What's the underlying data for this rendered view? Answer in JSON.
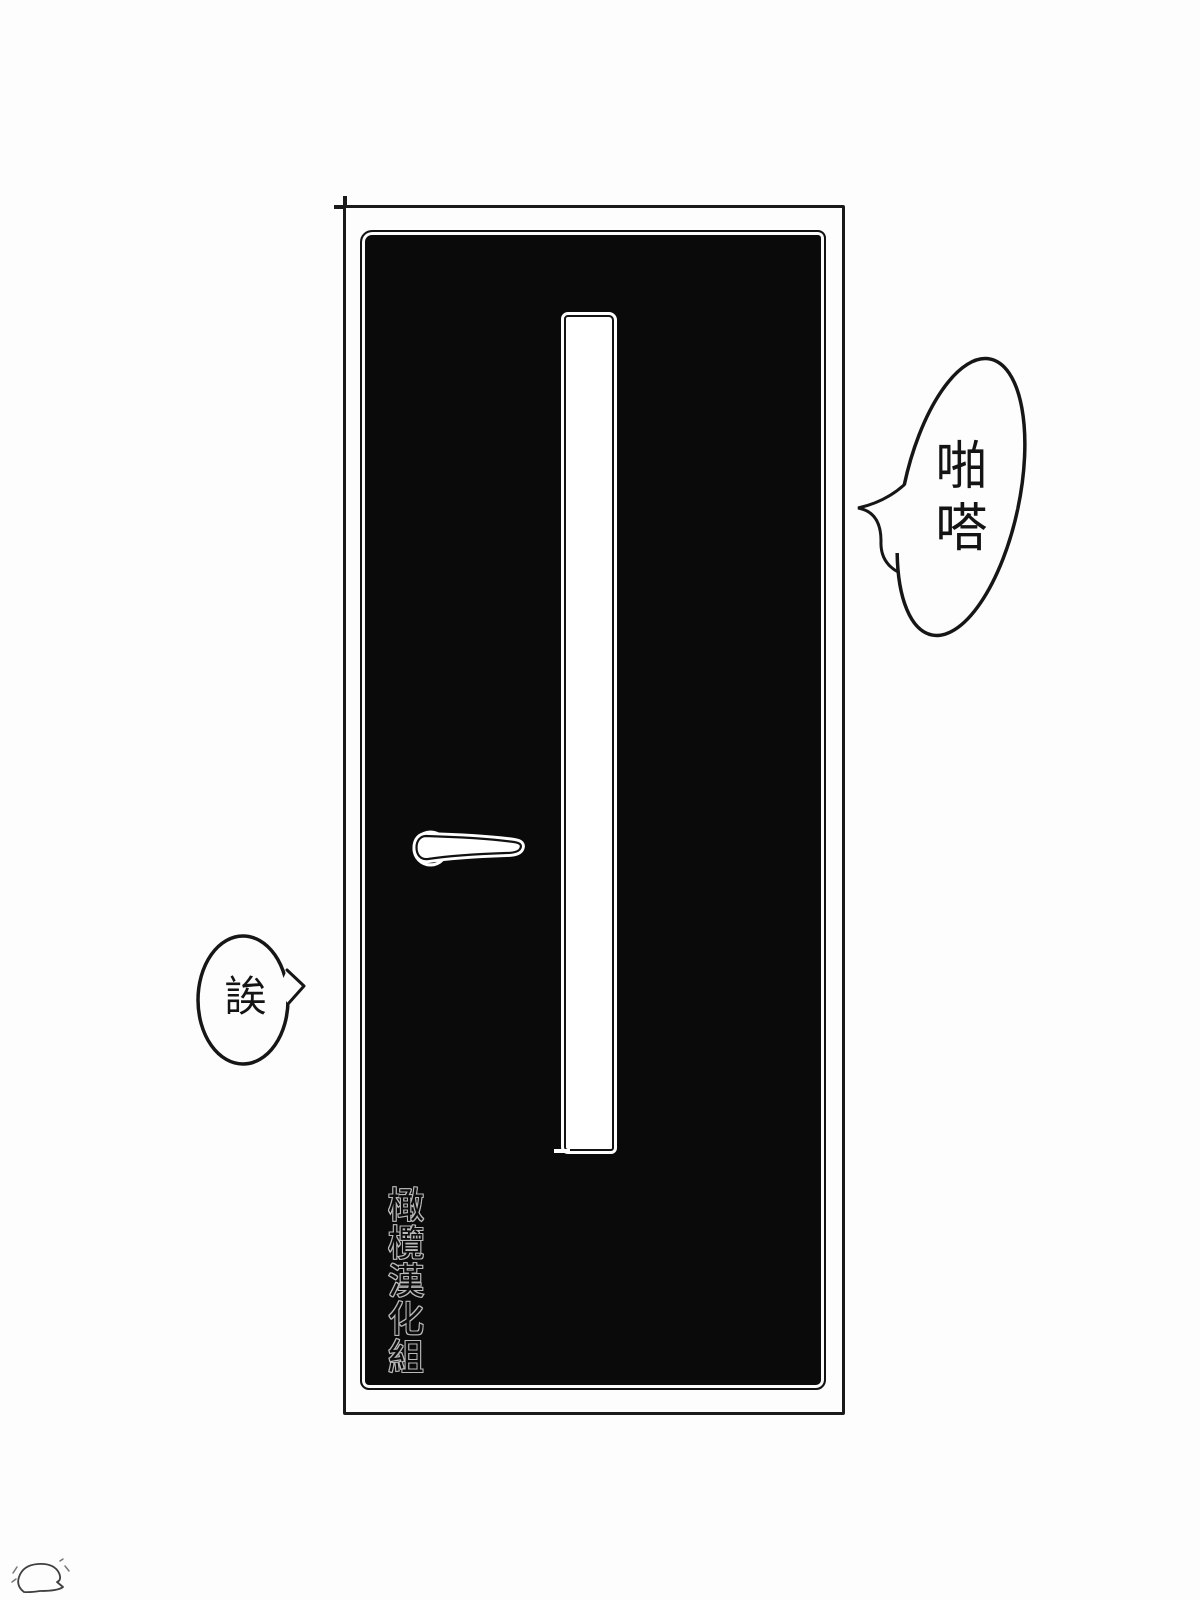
{
  "page": {
    "type": "manga-panel",
    "background_color": "#fdfdfd",
    "ink_color": "#161616"
  },
  "door": {
    "semantic": "closed-black-door-with-vertical-window-slit",
    "fill_color": "#0a0a0a",
    "handle_icon": "lever-door-handle"
  },
  "bubbles": {
    "sfx": {
      "text": "啪嗒",
      "shape": "tall-ellipse-left-tail"
    },
    "reply": {
      "text": "誒",
      "shape": "small-ellipse-right-tail"
    }
  },
  "credit": {
    "text": "橄欖漢化組",
    "orientation": "vertical",
    "outline_color": "#c9c9c9"
  },
  "doodle": {
    "semantic": "small-creature-sketch"
  }
}
